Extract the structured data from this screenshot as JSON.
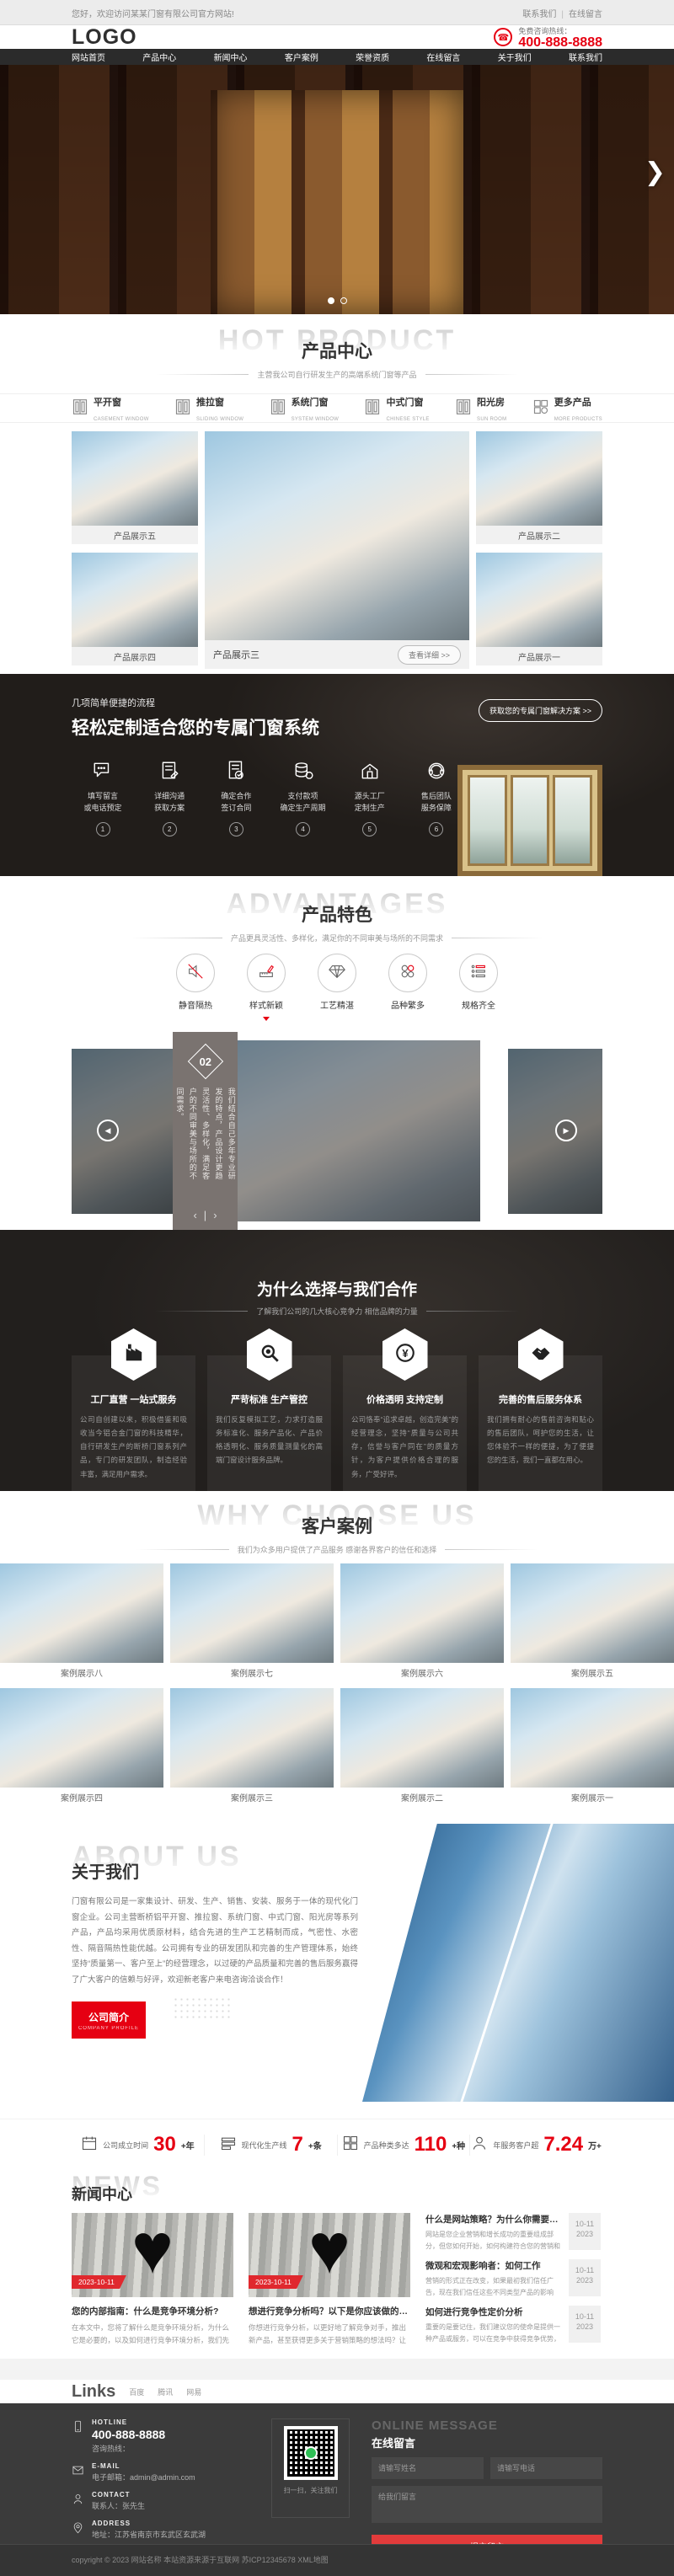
{
  "topbar": {
    "welcome": "您好，欢迎访问某某门窗有限公司官方网站!",
    "links": [
      "联系我们",
      "在线留言"
    ]
  },
  "header": {
    "logo": "LOGO",
    "hotline_label": "免费咨询热线：",
    "phone": "400-888-8888",
    "phone_icon": "☎"
  },
  "nav": {
    "items": [
      "网站首页",
      "产品中心",
      "新闻中心",
      "客户案例",
      "荣誉资质",
      "在线留言",
      "关于我们",
      "联系我们"
    ]
  },
  "banner": {
    "next_arrow": "❯"
  },
  "products": {
    "ghost": "HOT PRODUCT",
    "title": "产品中心",
    "subtitle": "主营我公司自行研发生产的高端系统门窗等产品",
    "tabs": [
      {
        "cn": "平开窗",
        "en": "CASEMENT WINDOW"
      },
      {
        "cn": "推拉窗",
        "en": "SLIDING WINDOW"
      },
      {
        "cn": "系统门窗",
        "en": "SYSTEM WINDOW"
      },
      {
        "cn": "中式门窗",
        "en": "CHINESE STYLE"
      },
      {
        "cn": "阳光房",
        "en": "SUN ROOM"
      },
      {
        "cn": "更多产品",
        "en": "MORE PRODUCTS"
      }
    ],
    "left": [
      {
        "title": "产品展示五"
      },
      {
        "title": "产品展示四"
      }
    ],
    "featured": {
      "title": "产品展示三",
      "button": "查看详细 >>"
    },
    "right": [
      {
        "title": "产品展示二"
      },
      {
        "title": "产品展示一"
      }
    ]
  },
  "process": {
    "small_title": "几项简单便捷的流程",
    "big_title": "轻松定制适合您的专属门窗系统",
    "button": "获取您的专属门窗解决方案 >>",
    "steps": [
      {
        "num": "1",
        "line1": "填写留言",
        "line2": "或电话预定"
      },
      {
        "num": "2",
        "line1": "详细沟通",
        "line2": "获取方案"
      },
      {
        "num": "3",
        "line1": "确定合作",
        "line2": "签订合同"
      },
      {
        "num": "4",
        "line1": "支付款项",
        "line2": "确定生产周期"
      },
      {
        "num": "5",
        "line1": "源头工厂",
        "line2": "定制生产"
      },
      {
        "num": "6",
        "line1": "售后团队",
        "line2": "服务保障"
      }
    ]
  },
  "advantages": {
    "ghost": "ADVANTAGES",
    "title": "产品特色",
    "subtitle": "产品更具灵活性、多样化，满足你的不同审美与场所的不同需求",
    "features": [
      {
        "label": "静音隔热"
      },
      {
        "label": "样式新颖"
      },
      {
        "label": "工艺精湛"
      },
      {
        "label": "品种繁多"
      },
      {
        "label": "规格齐全"
      }
    ]
  },
  "carousel": {
    "number": "02",
    "text": "我们结合自己多年专业研发的特点，产品设计更趋灵活性、多样化，满足客户的不同审美与场所的不同需求。",
    "prev": "‹",
    "next": "›",
    "arrow_left": "◀",
    "arrow_right": "▶"
  },
  "why": {
    "title": "为什么选择与我们合作",
    "subtitle": "了解我们公司的几大核心竞争力 相信品牌的力量",
    "cards": [
      {
        "title": "工厂直营 一站式服务",
        "desc": "公司自创建以来，积极借鉴和吸收当今铝合金门窗的科技精华，自行研发生产的断桥门窗系列产品，专门的研发团队，制造经验丰富，满足用户需求。"
      },
      {
        "title": "严苛标准 生产管控",
        "desc": "我们反复模拟工艺，力求打造服务标准化、服务产品化、产品价格透明化、服务质量测量化的高端门窗设计服务品牌。"
      },
      {
        "title": "价格透明 支持定制",
        "desc": "公司恪奉“追求卓越，创造完美”的经营理念，坚持“质量与公司共存，信誉与客户同在”的质量方针，为客户提供价格合理的服务，广受好评。"
      },
      {
        "title": "完善的售后服务体系",
        "desc": "我们拥有耐心的售前咨询和贴心的售后团队，呵护您的生活，让您体验不一样的便捷，为了便捷您的生活，我们一直都在用心。"
      }
    ]
  },
  "cases": {
    "ghost": "WHY CHOOSE US",
    "title": "客户案例",
    "subtitle": "我们为众多用户提供了产品服务 感谢各界客户的信任和选择",
    "items": [
      {
        "title": "案例展示八"
      },
      {
        "title": "案例展示七"
      },
      {
        "title": "案例展示六"
      },
      {
        "title": "案例展示五"
      },
      {
        "title": "案例展示四"
      },
      {
        "title": "案例展示三"
      },
      {
        "title": "案例展示二"
      },
      {
        "title": "案例展示一"
      }
    ]
  },
  "about": {
    "ghost": "ABOUT US",
    "title": "关于我们",
    "paragraph": "门窗有限公司是一家集设计、研发、生产、销售、安装、服务于一体的现代化门窗企业。公司主营断桥铝平开窗、推拉窗、系统门窗、中式门窗、阳光房等系列产品，产品均采用优质原材料，结合先进的生产工艺精制而成，气密性、水密性、隔音隔热性能优越。公司拥有专业的研发团队和完善的生产管理体系，始终坚持“质量第一、客户至上”的经营理念，以过硬的产品质量和完善的售后服务赢得了广大客户的信赖与好评，欢迎新老客户来电咨询洽谈合作！",
    "button_cn": "公司简介",
    "button_en": "COMPANY PROFILE"
  },
  "stats": {
    "items": [
      {
        "label": "公司成立时间",
        "value": "30",
        "unit": "+年"
      },
      {
        "label": "现代化生产线",
        "value": "7",
        "unit": "+条"
      },
      {
        "label": "产品种类多达",
        "value": "110",
        "unit": "+种"
      },
      {
        "label": "年服务客户超",
        "value": "7.24",
        "unit": "万+"
      }
    ]
  },
  "news": {
    "ghost": "NEWS",
    "title": "新闻中心",
    "featured": [
      {
        "date": "2023-10-11",
        "title": "您的内部指南：什么是竞争环境分析?",
        "excerpt": "在本文中，您将了解什么是竞争环境分析，为什么它是必要的，以及如何进行竞争环境分析，我们先让其在世界上…"
      },
      {
        "date": "2023-10-11",
        "title": "想进行竞争分析吗？以下是你应该做的7个理...",
        "excerpt": "你想进行竞争分析，以更好地了解竞争对手，推出新产品，甚至获得更多关于营销策略的想法吗？让我们看看你应…"
      }
    ],
    "list": [
      {
        "title": "什么是网站策略？为什么你需要它...",
        "excerpt": "网站是您企业营销和增长成功的重要组成部分，但您如何开始，如何构建符合您的营销和业务目标的网站呢？每…",
        "date_md": "10-11",
        "date_y": "2023"
      },
      {
        "title": "微观和宏观影响者：如何工作",
        "excerpt": "营销的形式正在改变，如果最初我们信任广告，现在我们信任这些不同类型产品的影响者，这些天，有影响力的人…",
        "date_md": "10-11",
        "date_y": "2023"
      },
      {
        "title": "如何进行竞争性定价分析",
        "excerpt": "重要的是要记住，我们建议您的使命是提供一种产品或服务，可以在竞争中获得竞争优势，但您仍然希望获得利润…",
        "date_md": "10-11",
        "date_y": "2023"
      }
    ]
  },
  "links": {
    "title": "Links",
    "items": [
      "百度",
      "腾讯",
      "网易"
    ]
  },
  "footer": {
    "contacts": [
      {
        "en": "HOTLINE",
        "label": "咨询热线：",
        "value": "400-888-8888"
      },
      {
        "en": "E-MAIL",
        "label": "电子邮箱：",
        "value": "admin@admin.com"
      },
      {
        "en": "CONTACT",
        "label": "联系人：",
        "value": "张先生"
      },
      {
        "en": "ADDRESS",
        "label": "地址：",
        "value": "江苏省南京市玄武区玄武湖"
      }
    ],
    "qr_caption": "扫一扫，关注我们",
    "message": {
      "ghost": "ONLINE MESSAGE",
      "title": "在线留言",
      "name_ph": "请输写姓名",
      "phone_ph": "请输写电话",
      "msg_ph": "给我们留言",
      "submit": "提交留言"
    },
    "copyright": "copyright © 2023 网站名称 本站资源来源于互联网 苏ICP12345678 XML地图"
  },
  "colors": {
    "accent": "#e60012",
    "nav_bg": "#2b2b2b",
    "footer_bg": "#3b3b3b"
  }
}
